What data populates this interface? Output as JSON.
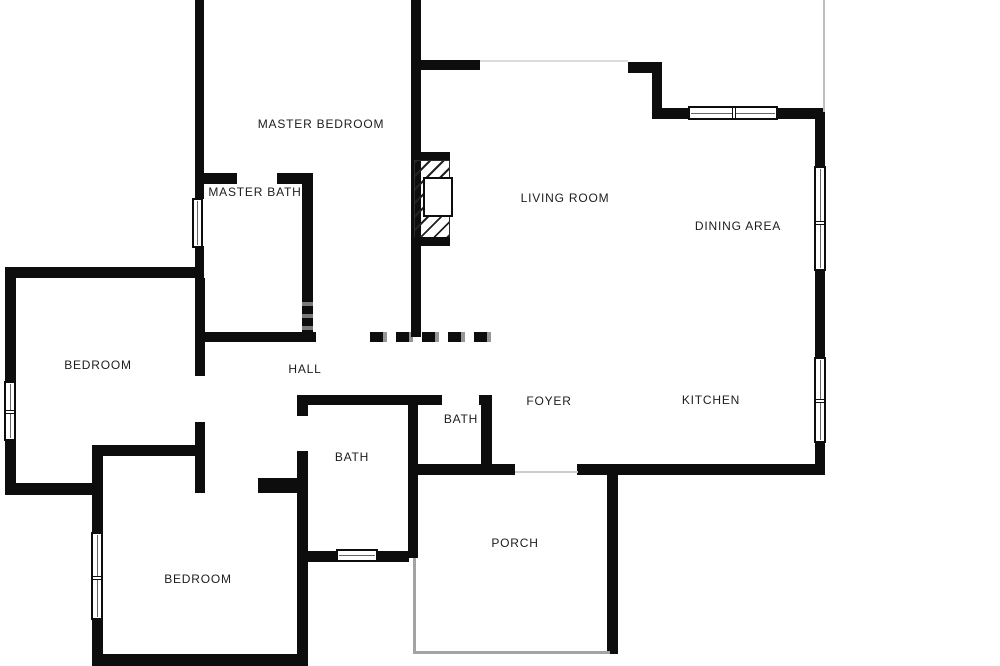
{
  "plan_title": "Single-story residence floor plan",
  "colors": {
    "wall": "#0d0d0d",
    "background": "#ffffff",
    "thin_line": "#c0c0c0",
    "watermark_grey": "#969696",
    "label_text": "#1c1c1c"
  },
  "rooms": [
    {
      "id": "master-bedroom",
      "label": "MASTER BEDROOM"
    },
    {
      "id": "master-bath",
      "label": "MASTER BATH"
    },
    {
      "id": "living-room",
      "label": "LIVING ROOM"
    },
    {
      "id": "dining-area",
      "label": "DINING AREA"
    },
    {
      "id": "bedroom-upper",
      "label": "BEDROOM"
    },
    {
      "id": "hall",
      "label": "HALL"
    },
    {
      "id": "bath-center",
      "label": "BATH"
    },
    {
      "id": "bath-small",
      "label": "BATH"
    },
    {
      "id": "foyer",
      "label": "FOYER"
    },
    {
      "id": "kitchen",
      "label": "KITCHEN"
    },
    {
      "id": "bedroom-lower",
      "label": "BEDROOM"
    },
    {
      "id": "porch",
      "label": "PORCH"
    }
  ],
  "features": {
    "fireplace": "hatched masonry fireplace on living-room side of central wall",
    "window_symbols": [
      "master-bath west wall",
      "upper-bedroom west wall",
      "dining north wall",
      "dining east wall",
      "kitchen east wall",
      "center-bath south wall",
      "lower-bedroom west wall"
    ]
  }
}
